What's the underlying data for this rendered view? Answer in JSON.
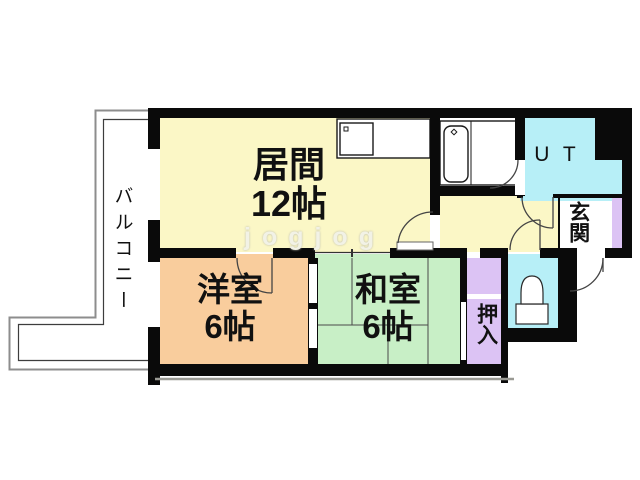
{
  "title": "2LDK apartment floor plan",
  "rooms": {
    "living": {
      "name": "居間",
      "size": "12帖"
    },
    "western": {
      "name": "洋室",
      "size": "6帖"
    },
    "japanese": {
      "name": "和室",
      "size": "6帖"
    },
    "balcony": {
      "name": "バルコニー"
    },
    "utility": {
      "name": "U T"
    },
    "entrance": {
      "name": "玄関"
    },
    "closet": {
      "name": "押入"
    }
  },
  "watermark": "jogjog",
  "colors": {
    "living_yellow": "#FBF7C6",
    "western_orange": "#F9CD9D",
    "japanese_green": "#C8EFC6",
    "water_cyan": "#B7EFF7",
    "closet_purple": "#DCC3F4",
    "wall_black": "#0A0A0A"
  }
}
